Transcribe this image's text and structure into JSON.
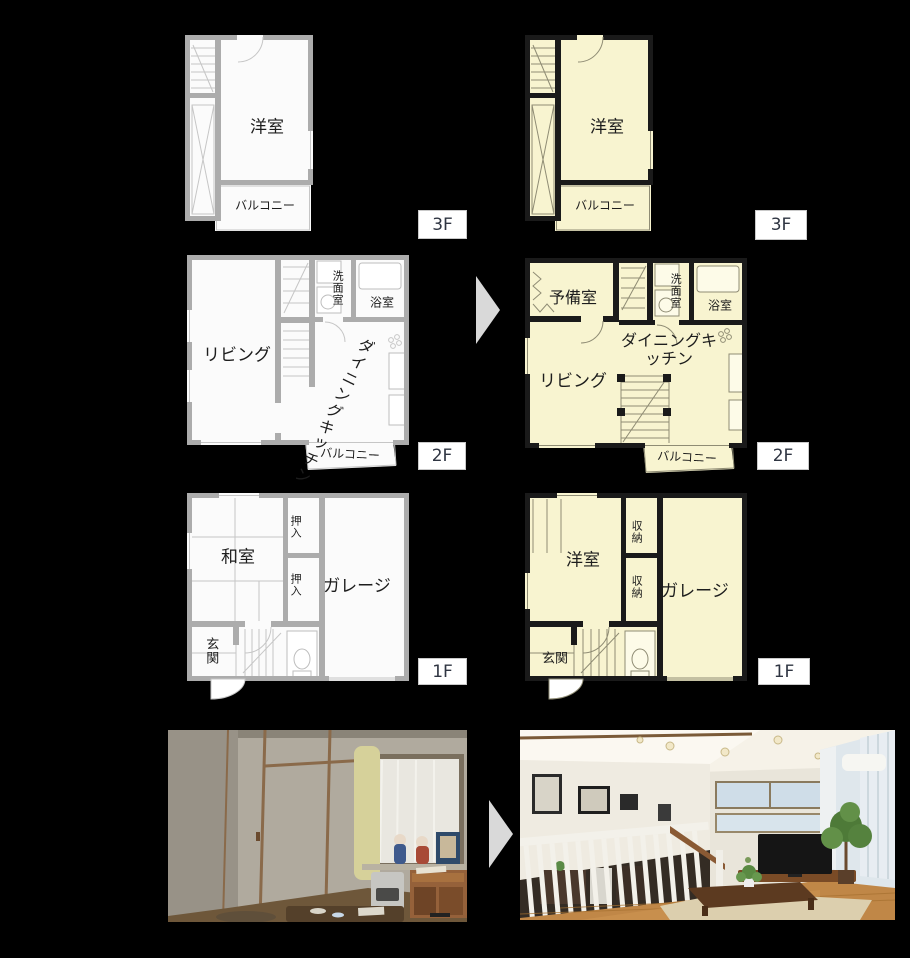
{
  "colors": {
    "background": "#000000",
    "before_wall": "#acacac",
    "before_floor": "#fbfbfb",
    "after_wall": "#1a1a1a",
    "after_floor": "#f8f4d0",
    "arrow": "#d9d9d9",
    "floor_tag_bg": "#ffffff",
    "floor_tag_text": "#2f3542"
  },
  "floors": [
    {
      "tag": "3F",
      "before": {
        "room": "洋室",
        "balcony": "バルコニー"
      },
      "after": {
        "room": "洋室",
        "balcony": "バルコニー"
      }
    },
    {
      "tag": "2F",
      "before": {
        "living": "リビング",
        "dining": "ダイニングキッチン",
        "washroom": "洗面室",
        "bath": "浴室",
        "balcony": "バルコニー"
      },
      "after": {
        "spare": "予備室",
        "living": "リビング",
        "dining": "ダイニングキッチン",
        "washroom": "洗面室",
        "bath": "浴室",
        "balcony": "バルコニー"
      }
    },
    {
      "tag": "1F",
      "before": {
        "room": "和室",
        "closet_upper": "押入",
        "closet_lower": "押入",
        "garage": "ガレージ",
        "entrance": "玄関"
      },
      "after": {
        "room": "洋室",
        "storage_upper": "収納",
        "storage_lower": "収納",
        "garage": "ガレージ",
        "entrance": "玄関"
      }
    }
  ]
}
